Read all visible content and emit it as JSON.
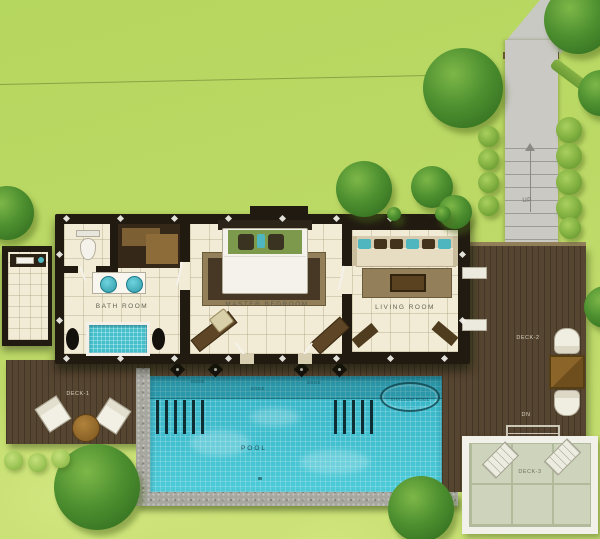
{
  "rooms": {
    "bathroom": "BATH ROOM",
    "master_bedroom": "MASTER BEDROOM",
    "living_room": "LIVING ROOM"
  },
  "pool": {
    "name": "POOL",
    "shallow_zone": "SHALLOW POOL",
    "edge_marker": "EDGE"
  },
  "decks": {
    "deck_1": "DECK-1",
    "deck_2": "DECK-2",
    "deck_3": "DECK-3"
  },
  "stairs": {
    "up": "UP",
    "down": "DN"
  },
  "colors": {
    "lawn": "#bcd966",
    "tree": "#4e9030",
    "pool_water": "#3fc0d0",
    "deck_wood": "#564530",
    "building_wall": "#211a11",
    "stone_border": "#a7a7a0",
    "patio_pavers": "#ced4bb",
    "accent_teal": "#4fb6c0",
    "room_floor": "#f2ecd6"
  }
}
